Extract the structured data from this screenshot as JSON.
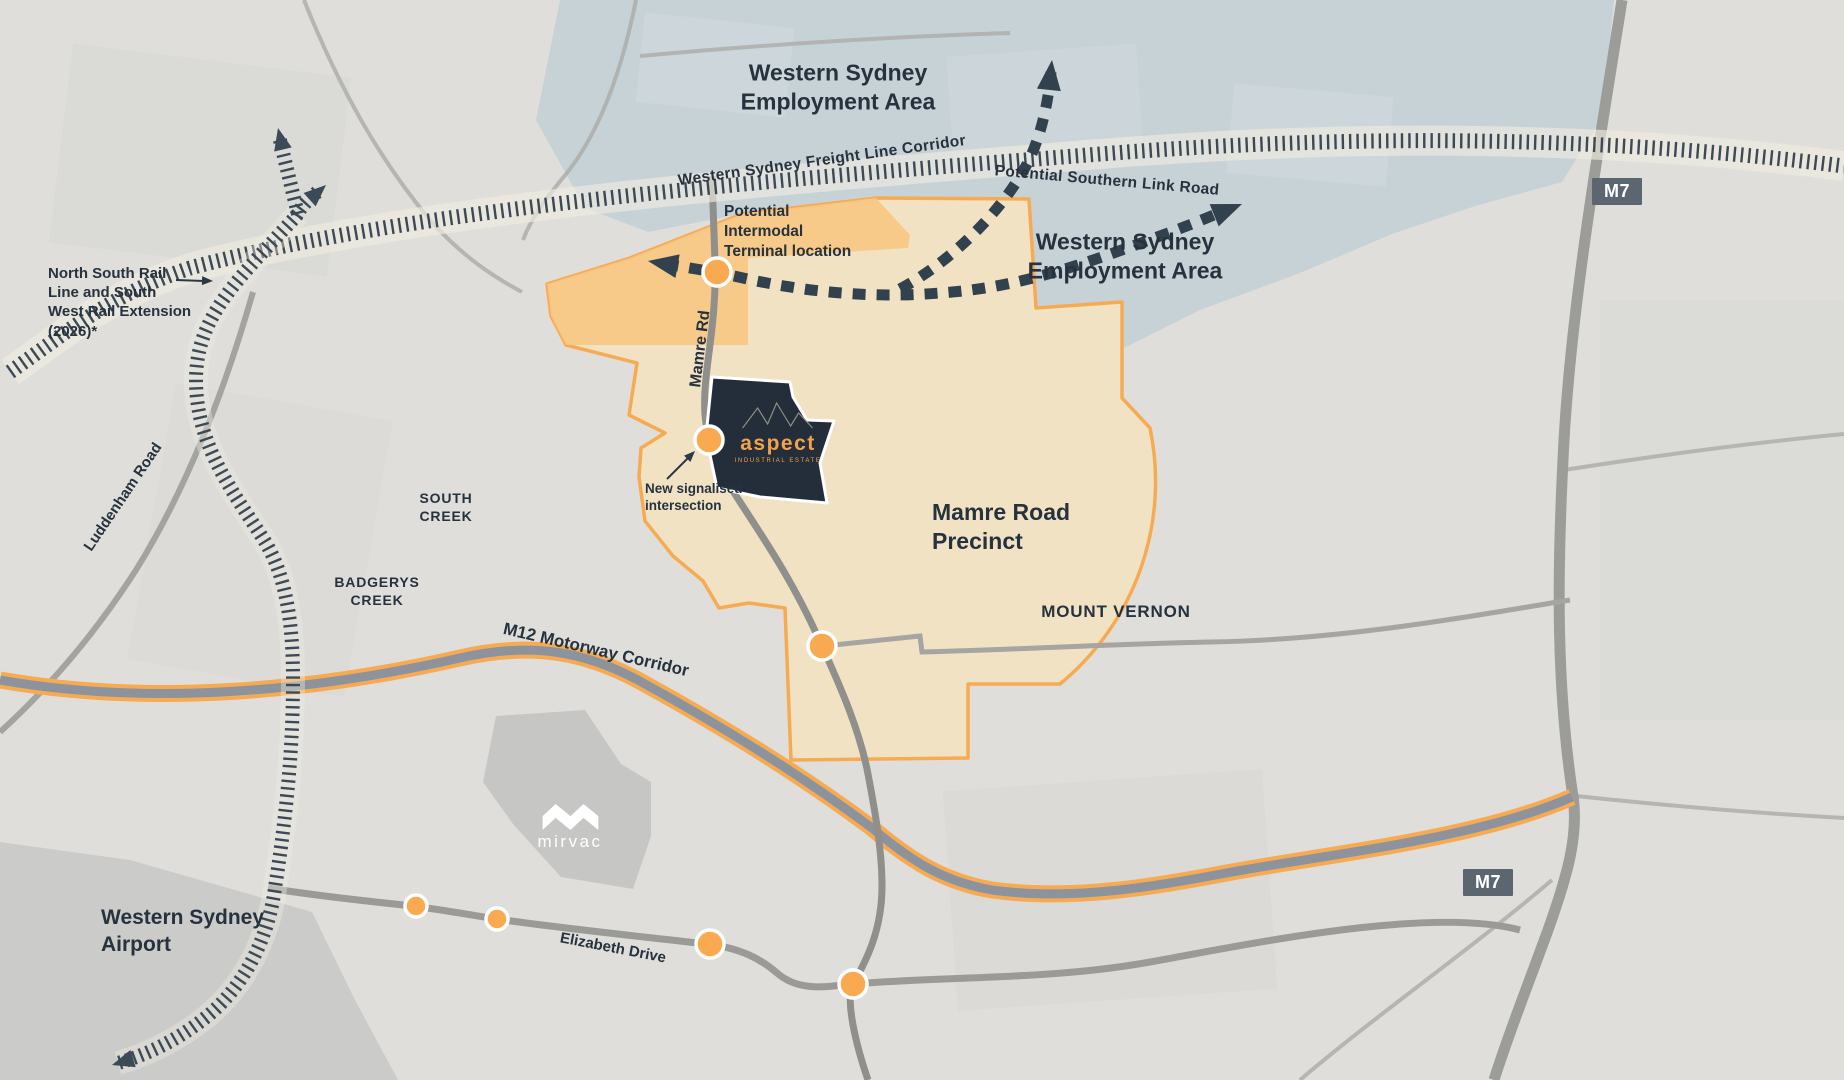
{
  "map": {
    "title": "Aspect Industrial Estate location map",
    "colors": {
      "background": "#dfdedb",
      "employment_area_blue": "#c7d2d6",
      "precinct_tan": "#f2e2c4",
      "precinct_border_orange": "#f6ab53",
      "intermodal_patch_orange": "#f8c884",
      "estate_navy": "#232e3a",
      "accent_orange": "#f2a24b",
      "dot_orange": "#f9aa50",
      "label_navy": "#26323e",
      "road_grey": "#9c9c99",
      "motorway_badge_grey": "#5b6670",
      "rail_tick_navy": "#3c4956"
    },
    "labels": {
      "wsea_top": "Western Sydney\nEmployment Area",
      "wsea_right": "Western Sydney\nEmployment Area",
      "freight_corridor": "Western Sydney Freight Line Corridor",
      "southern_link": "Potential Southern Link Road",
      "north_south_rail": "North South Rail\nLine and South\nWest Rail Extension\n(2026)*",
      "intermodal": "Potential\nIntermodal\nTerminal location",
      "mamre_rd": "Mamre Rd",
      "new_signalised": "New signalised\nintersection",
      "south_creek": "SOUTH\nCREEK",
      "badgerys_creek": "BADGERYS\nCREEK",
      "precinct": "Mamre Road\nPrecinct",
      "mount_vernon": "MOUNT VERNON",
      "m12": "M12 Motorway Corridor",
      "luddenham": "Luddenham Road",
      "airport": "Western Sydney\nAirport",
      "elizabeth": "Elizabeth Drive",
      "m7_top": "M7",
      "m7_bottom": "M7"
    },
    "logos": {
      "aspect": {
        "name": "aspect",
        "tagline": "INDUSTRIAL ESTATE"
      },
      "mirvac": {
        "name": "mirvac"
      }
    }
  }
}
